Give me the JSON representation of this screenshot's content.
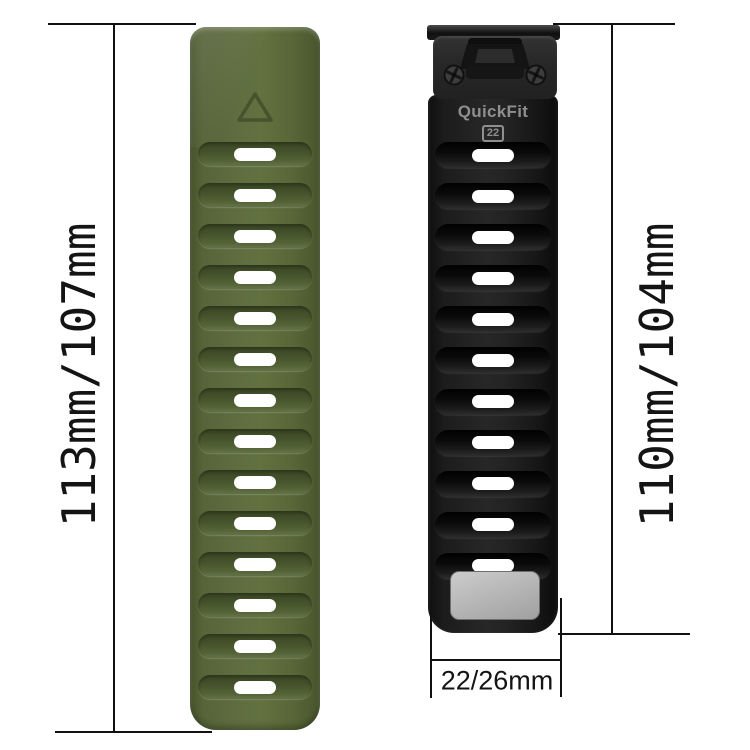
{
  "dimensions": {
    "left_length": "113mm/107mm",
    "right_length": "110mm/104mm",
    "width": "22/26mm"
  },
  "connector": {
    "brand": "QuickFit",
    "size": "22"
  },
  "left_band": {
    "color": "#5f6e41",
    "hole_count": 14,
    "marker": "triangle"
  },
  "right_band": {
    "color": "#222222",
    "hole_count": 11,
    "keeper_color": "#b5b5b5"
  },
  "annotation_color": "#111111"
}
